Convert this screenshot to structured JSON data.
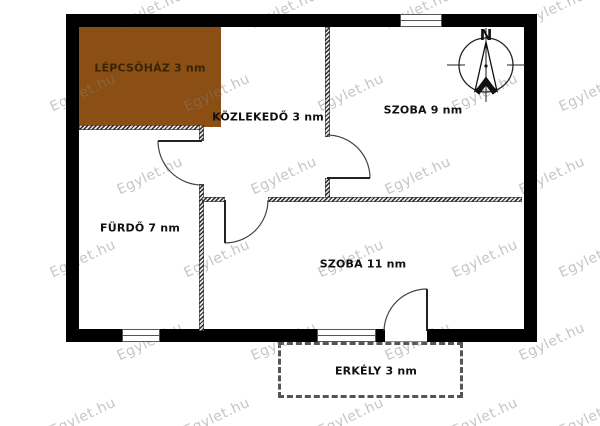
{
  "watermark": {
    "text": "Egylet.hu"
  },
  "rooms": {
    "lepcsohaz": {
      "label": "LÉPCSŐHÁZ 3 nm"
    },
    "kozlekedo": {
      "label": "KÖZLEKEDŐ 3 nm"
    },
    "szoba9": {
      "label": "SZOBA 9 nm"
    },
    "furdo": {
      "label": "FÜRDŐ 7 nm"
    },
    "szoba11": {
      "label": "SZOBA 11 nm"
    },
    "erkely": {
      "label": "ERKÉLY 3 nm"
    }
  },
  "compass": {
    "north_label": "N"
  },
  "colors": {
    "wall": "#000000",
    "staircase_fill": "#8B4E14",
    "staircase_text": "#3A2404",
    "label_text": "#111111",
    "watermark_text": "#808080"
  }
}
